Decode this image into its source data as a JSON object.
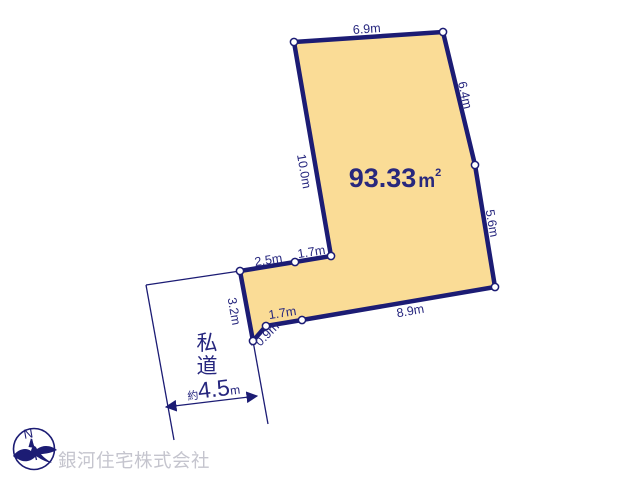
{
  "colors": {
    "navy_line": "#1C1C74",
    "navy_text": "#26267E",
    "plot_fill": "#FADC96",
    "company_gray": "#C5C5CE",
    "background": "#FFFFFF"
  },
  "plot": {
    "area_value": "93.33",
    "area_unit": "m",
    "area_exponent": "2",
    "dimensions": {
      "top": "6.9m",
      "upper_right": "6.4m",
      "lower_right": "5.6m",
      "left": "10.0m",
      "bottom": "8.9m",
      "inner_upper_left": "2.5m",
      "inner_upper_right": "1.7m",
      "inner_lower": "1.7m",
      "diagonal": "0.9m",
      "west_side": "3.2m"
    }
  },
  "road": {
    "label_char_1": "私",
    "label_char_2": "道",
    "width_prefix": "約",
    "width_value": "4.5",
    "width_unit": "m"
  },
  "compass": {
    "north_label": "N"
  },
  "footer": {
    "company_name": "銀河住宅株式会社"
  }
}
